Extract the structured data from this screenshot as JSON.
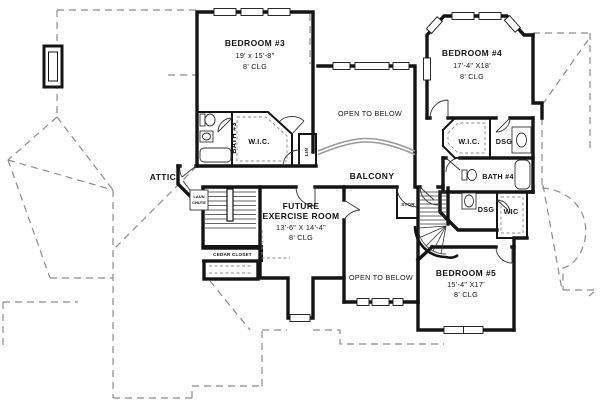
{
  "plan": {
    "rooms": {
      "bedroom3": {
        "name": "BEDROOM #3",
        "dims": "19' x 15'-8\"",
        "clg": "8' CLG"
      },
      "bedroom4": {
        "name": "BEDROOM #4",
        "dims": "17'-4\" X18'",
        "clg": "8' CLG"
      },
      "bedroom5": {
        "name": "BEDROOM #5",
        "dims": "15'-4\" X17'",
        "clg": "8' CLG"
      },
      "exercise": {
        "name_line1": "FUTURE",
        "name_line2": "EXERCISE ROOM",
        "dims": "13'-6\" X 14'-4\"",
        "clg": "8' CLG"
      },
      "open_below_upper": {
        "label": "OPEN TO BELOW"
      },
      "open_below_lower": {
        "label": "OPEN TO BELOW"
      },
      "balcony": {
        "label": "BALCONY"
      },
      "attic": {
        "label": "ATTIC"
      },
      "bath3": {
        "label": "BATH #3"
      },
      "bath4": {
        "label": "BATH #4"
      },
      "wic_bedroom3": {
        "label": "W.I.C."
      },
      "wic_bedroom4": {
        "label": "W.I.C."
      },
      "wic_bedroom5": {
        "label": "WIC"
      },
      "dressing_upper": {
        "label": "DSG"
      },
      "dressing_lower": {
        "label": "DSG"
      },
      "linen": {
        "label": "LIN"
      },
      "storage": {
        "label": "STOR"
      },
      "laundry_chute": {
        "line1": "LAUN",
        "line2": "CHUTE"
      },
      "cedar_closet": {
        "label": "CEDAR CLOSET"
      }
    },
    "colors": {
      "wall": "#141414",
      "roof_dash": "#8c8c8c",
      "paper": "#ffffff"
    }
  }
}
